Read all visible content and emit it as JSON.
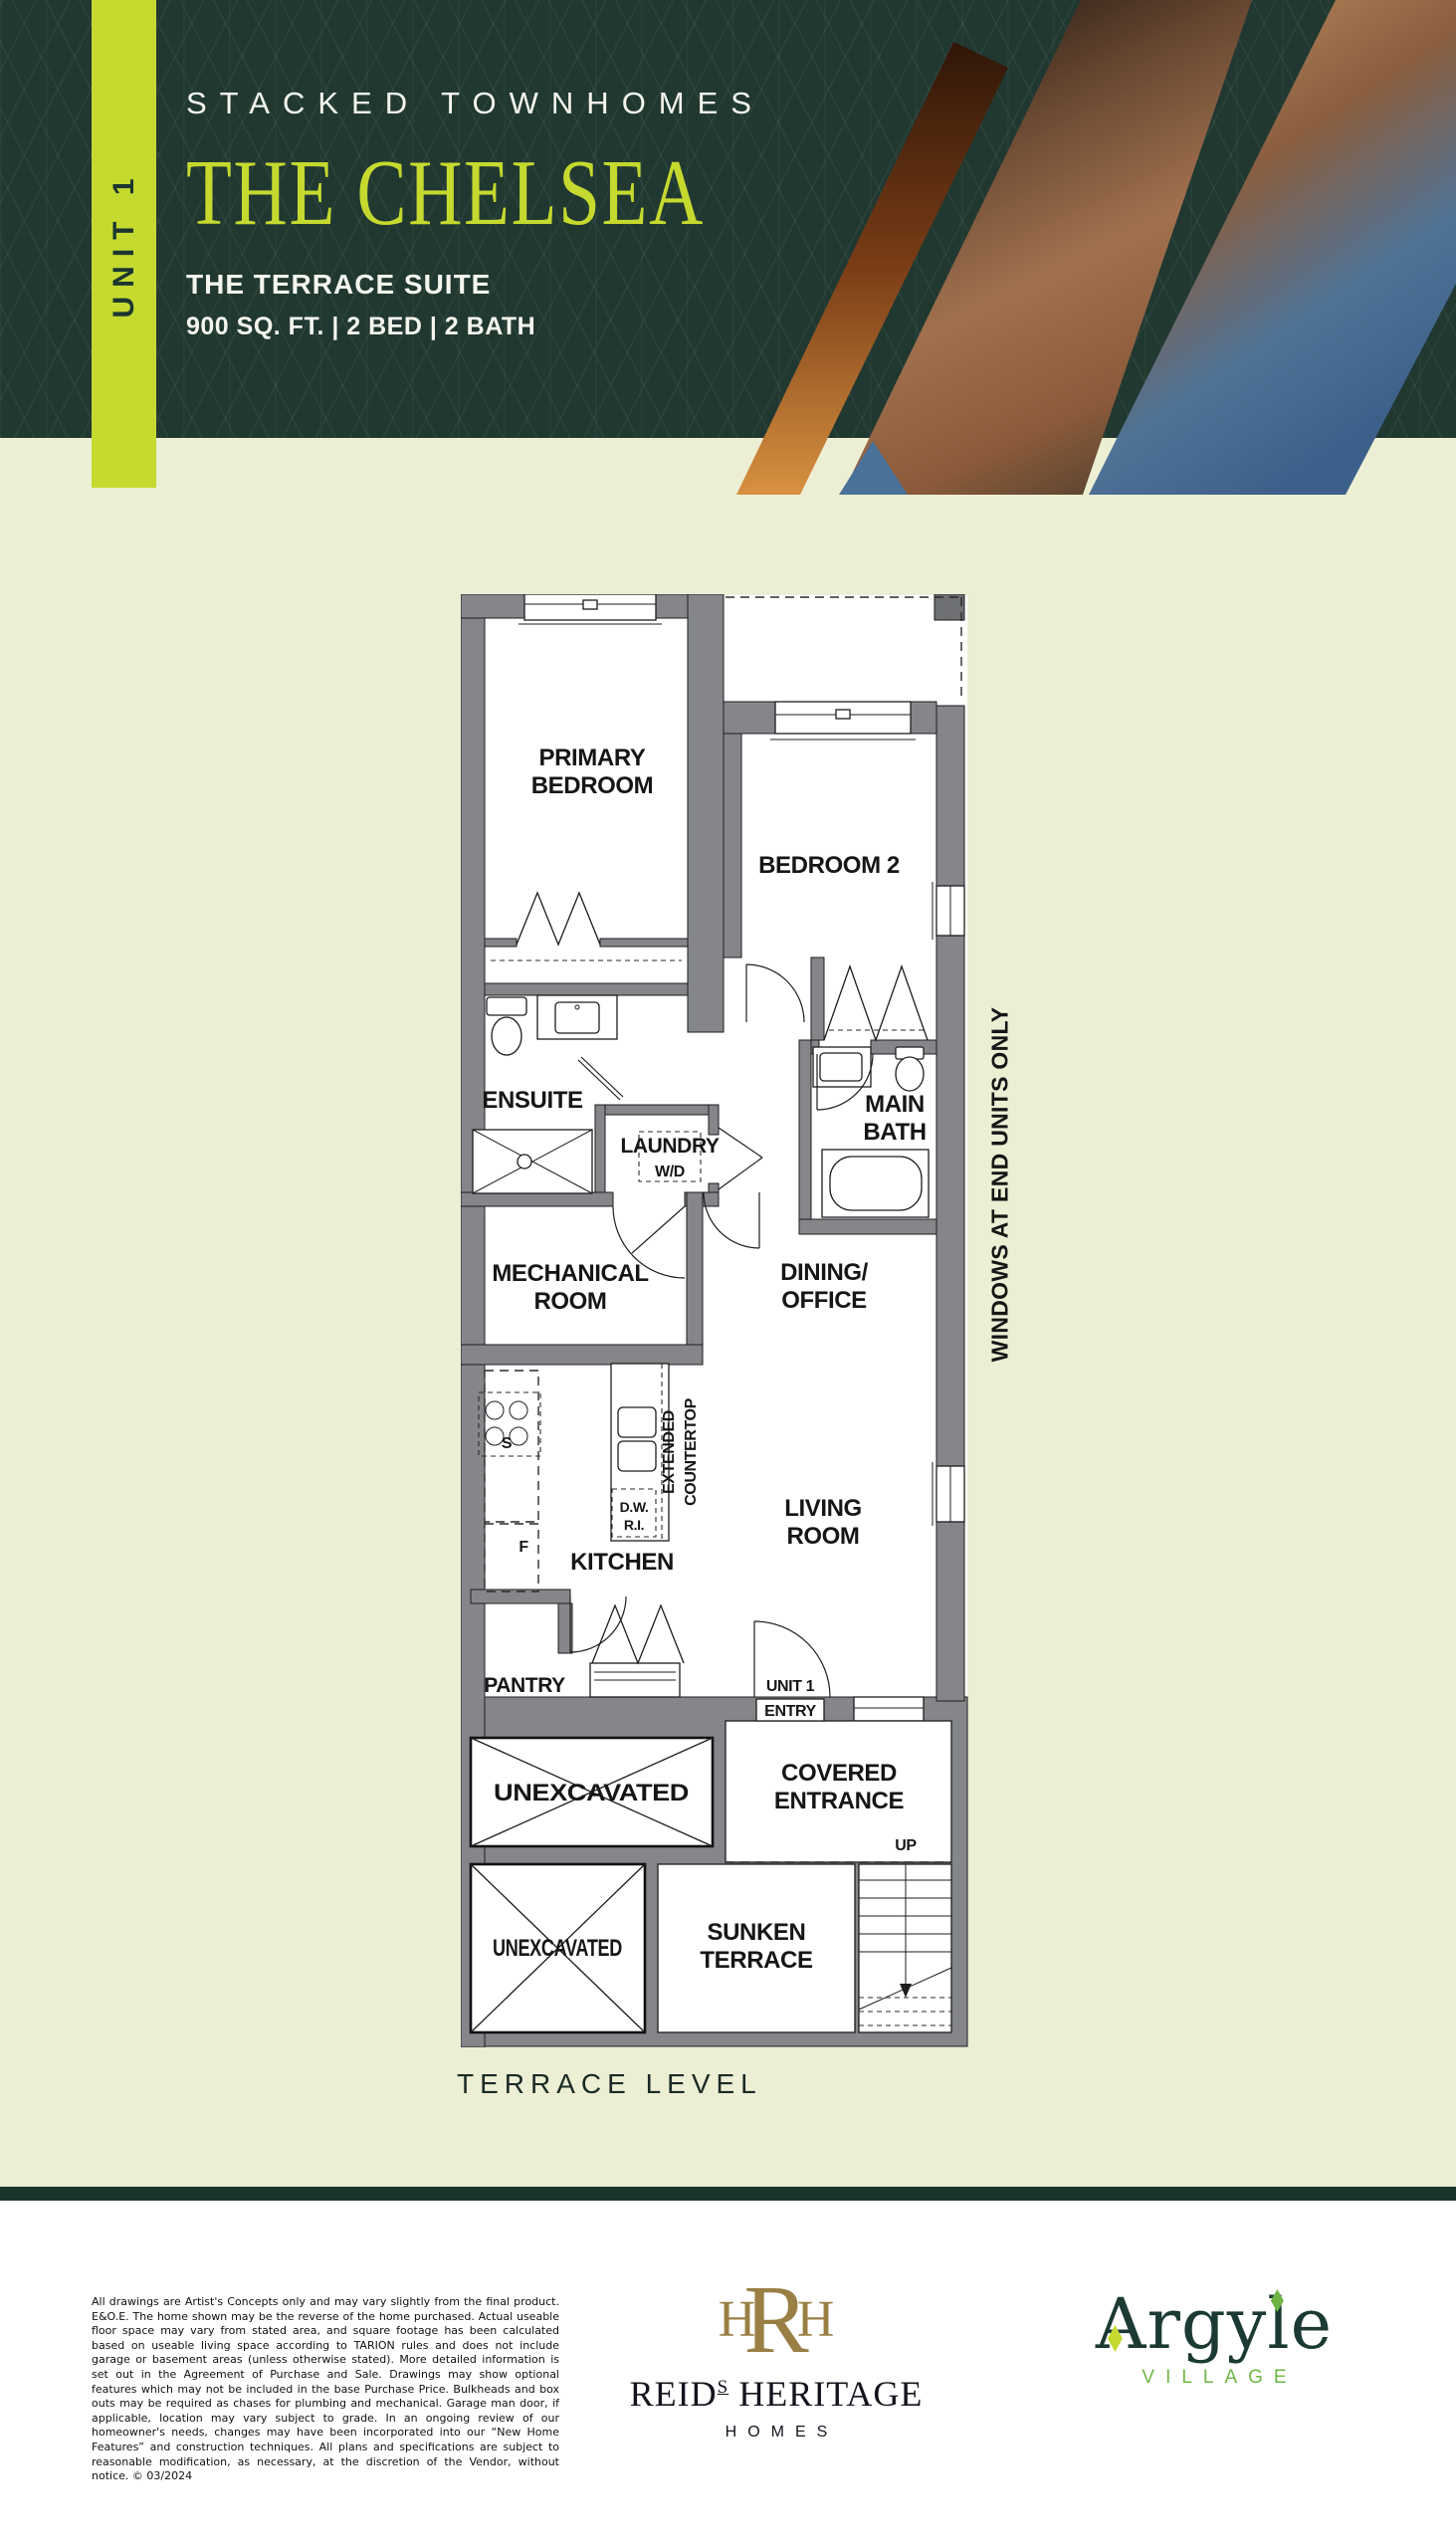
{
  "header": {
    "unit": "UNIT 1",
    "collection": "STACKED TOWNHOMES",
    "model": "THE CHELSEA",
    "suite": "THE TERRACE SUITE",
    "specs": "900 SQ. FT.  |  2 BED  |  2 BATH"
  },
  "plan": {
    "level": "TERRACE LEVEL",
    "note": "WINDOWS AT END UNITS ONLY",
    "rooms": {
      "primary1": "PRIMARY",
      "primary2": "BEDROOM",
      "bedroom2": "BEDROOM 2",
      "ensuite": "ENSUITE",
      "laundry": "LAUNDRY",
      "wd": "W/D",
      "bath1": "MAIN",
      "bath2": "BATH",
      "mech1": "MECHANICAL",
      "mech2": "ROOM",
      "dining1": "DINING/",
      "dining2": "OFFICE",
      "kitchen": "KITCHEN",
      "living1": "LIVING",
      "living2": "ROOM",
      "pantry": "PANTRY",
      "ext1": "EXTENDED",
      "ext2": "COUNTERTOP",
      "dw1": "D.W.",
      "dw2": "R.I.",
      "stove": "S",
      "fridge": "F",
      "entry1": "UNIT 1",
      "entry2": "ENTRY",
      "unexc1": "UNEXCAVATED",
      "unexc2": "UNEXCAVATED",
      "covered1": "COVERED",
      "covered2": "ENTRANCE",
      "up": "UP",
      "sunken1": "SUNKEN",
      "sunken2": "TERRACE"
    }
  },
  "footer": {
    "disclaimer": "All drawings are Artist's Concepts only and may vary slightly from the final product. E&O.E. The home shown may be the reverse of the home purchased. Actual useable floor space may vary from stated area, and square footage has been calculated based on useable living space according to TARION rules and does not include garage or basement areas (unless otherwise stated). More detailed information is set out in the Agreement of Purchase and Sale. Drawings may show optional features which may not be included in the base Purchase Price. Bulkheads and box outs may be required as chases for plumbing and mechanical. Garage man door, if applicable, location may vary subject to grade. In an ongoing review of our homeowner's needs, changes may have been incorporated into our “New Home Features” and construction techniques. All plans and specifications are subject to reasonable modification, as necessary, at the discretion of the Vendor, without notice. © 03/2024",
    "monogram_h1": "H",
    "monogram_r": "R",
    "monogram_h2": "H",
    "builder1": "REID",
    "builder_sup": "S",
    "builder2": "HERITAGE",
    "builder_sub": "HOMES",
    "community": "Argyle",
    "community_sub": "VILLAGE"
  },
  "colors": {
    "brand_green": "#213831",
    "lime": "#c5d92f",
    "pale_background": "#edefd5",
    "wall_gray": "#84868a",
    "builder_gold": "#9a7f45",
    "argyle_green": "#1b3a33",
    "village_green": "#6fb746"
  }
}
